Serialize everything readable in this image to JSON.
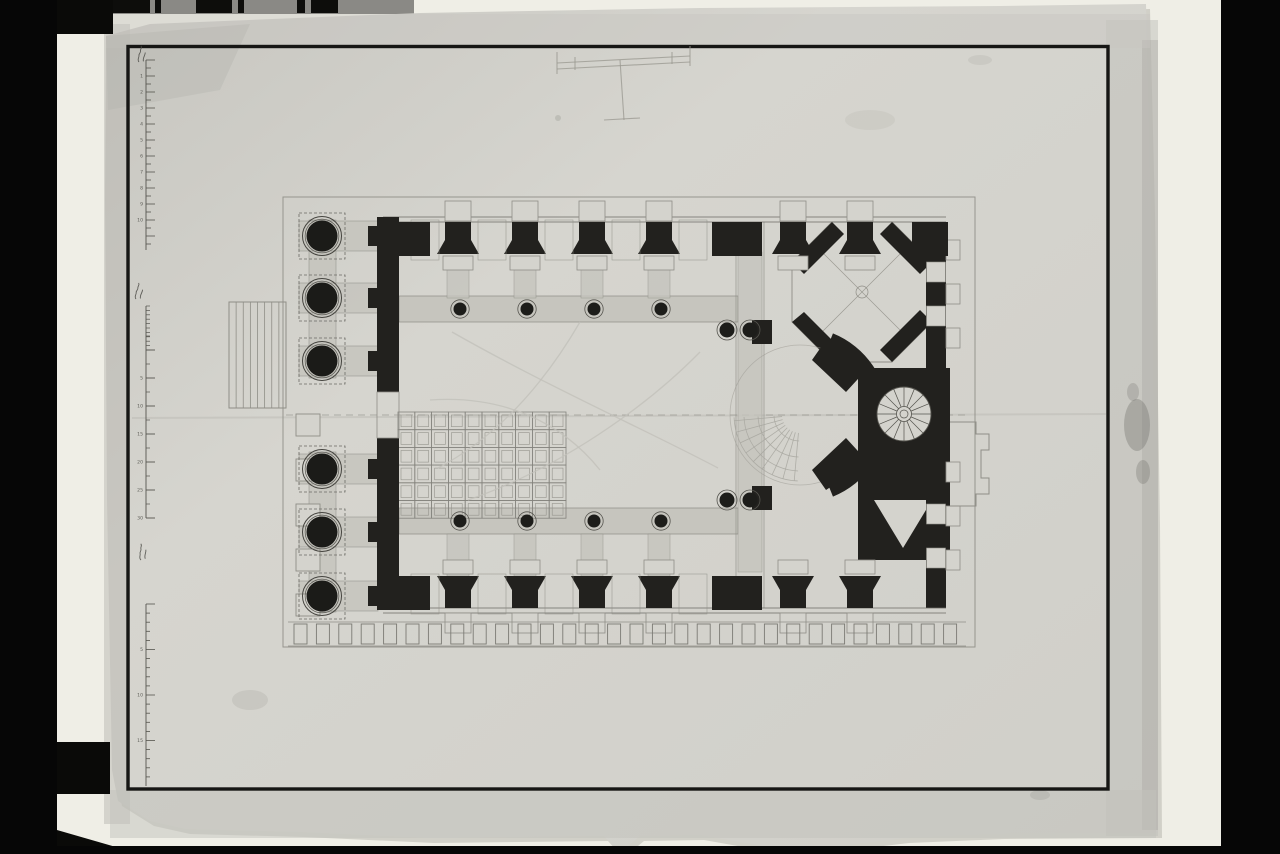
{
  "colors": {
    "photo_black": "#060606",
    "backdrop_white": "#efeee6",
    "paper": "#d4d3cd",
    "paper_edge": "#b9b8b2",
    "ink_border": "#161614",
    "ink": "#22211e",
    "wash": "#c6c5be",
    "wash_edge": "#8d8c85",
    "faint": "#8f8e87",
    "ghost": "#c2c1ba",
    "stain": "#6e6d66",
    "strip_grey": "#8a8985",
    "numeral": "#4a4a44"
  },
  "photo": {
    "left_bar": [
      0,
      0,
      57,
      854
    ],
    "right_bar": [
      1221,
      0,
      59,
      854
    ],
    "backdrop": [
      57,
      0,
      1164,
      848
    ],
    "top_left_block": [
      0,
      0,
      113,
      34
    ],
    "bottom_left_block": [
      56,
      742,
      54,
      52
    ],
    "bottom_strip": [
      0,
      846,
      1280,
      8
    ],
    "bottom_wedge": "57,830 57,854 140,854",
    "grey_strip": [
      106,
      0,
      308,
      14
    ],
    "grey_strip_blocks": [
      [
        112,
        38
      ],
      [
        155,
        6
      ],
      [
        196,
        36
      ],
      [
        238,
        6
      ],
      [
        297,
        8
      ],
      [
        311,
        27
      ]
    ]
  },
  "paper": {
    "outline": "106,36 150,24 420,13 700,8 1000,6 1146,4 1151,210 1156,520 1158,833 1000,834 905,838 830,847 762,846 700,835 640,836 628,846 612,845 604,836 430,838 300,832 186,829 150,821 118,801 112,770 107,500 105,200",
    "ink_border": [
      128,
      46.5,
      980,
      742.5
    ],
    "crease": [
      132,
      418,
      1106,
      414
    ],
    "stains": [
      [
        1137,
        425,
        13,
        26,
        0.35
      ],
      [
        1143,
        472,
        7,
        12,
        0.3
      ],
      [
        1133,
        392,
        6,
        9,
        0.25
      ],
      [
        558,
        118,
        3,
        3,
        0.2
      ],
      [
        250,
        700,
        18,
        10,
        0.12
      ],
      [
        1040,
        795,
        10,
        5,
        0.15
      ],
      [
        980,
        60,
        12,
        5,
        0.1
      ],
      [
        870,
        120,
        25,
        10,
        0.08
      ]
    ]
  },
  "sketch_t": {
    "paths": [
      "M557,63 L690,56",
      "M557,69 L690,62",
      "M557,52 L557,74",
      "M690,46 L690,66",
      "M620,60 L624,120",
      "M604,120 L640,118",
      "M575,57 L575,70",
      "M672,52 L672,64"
    ]
  },
  "rulers": {
    "a": {
      "x": 146,
      "y1": 60,
      "y2": 250,
      "pitch": 8,
      "len": 5,
      "long_len": 9,
      "long_every": 2,
      "numerals": [
        "1",
        "2",
        "3",
        "4",
        "5",
        "6",
        "7",
        "8",
        "9",
        "10"
      ],
      "label": [
        139,
        62,
        -72
      ]
    },
    "b": {
      "x": 146,
      "fine_y1": 306,
      "fine_y2": 350,
      "fine_pitch": 4.4,
      "major_y1": 350,
      "major_y2": 518,
      "major_pitch": 28,
      "len": 4,
      "long_len": 9,
      "numerals": [
        "5",
        "10",
        "15",
        "20",
        "25",
        "30"
      ],
      "label": [
        136,
        299,
        -70
      ]
    },
    "c": {
      "x": 146,
      "y1": 604,
      "y2": 786,
      "pitch": 9.1,
      "len": 4,
      "long_len": 9,
      "long_every": 5,
      "numerals": [
        "5",
        "10",
        "15",
        "20"
      ],
      "label": [
        141,
        560,
        -80
      ]
    }
  },
  "plan": {
    "outer": [
      283,
      197,
      692,
      450
    ],
    "axis": [
      286,
      415,
      970,
      415
    ],
    "portico": {
      "col_x": 322,
      "col_r": 15.5,
      "ring_r": 19.5,
      "plinth": 46,
      "rows": [
        236,
        298,
        361,
        469,
        532,
        596
      ],
      "hband": [
        299,
        378,
        30
      ],
      "vbands": [
        [
          309,
          220,
          27,
          158
        ],
        [
          309,
          452,
          27,
          160
        ]
      ]
    },
    "steps": {
      "x": 229,
      "y": 302,
      "w": 57,
      "h": 106,
      "risers": 7
    },
    "west_wall": {
      "x": 377,
      "w": 22,
      "segs": [
        [
          217,
          392
        ],
        [
          438,
          608
        ]
      ],
      "tab_rows": [
        236,
        298,
        361,
        469,
        532,
        596
      ]
    },
    "west_pilasters": {
      "x": 296,
      "w": 24,
      "h": 22,
      "cys": [
        425,
        470,
        515,
        560,
        605
      ]
    },
    "wall_piers": [
      458,
      525,
      592,
      659
    ],
    "east_piers": [
      793,
      860
    ],
    "gaps": [
      425,
      492,
      559,
      626,
      693
    ],
    "north": {
      "lines": [
        217,
        222
      ],
      "pier_y": [
        222,
        240,
        254
      ],
      "tab_y": 201,
      "base_y": 256,
      "wash": [
        258,
        40
      ],
      "corners": [
        [
          377,
          53
        ],
        [
          712,
          50
        ],
        [
          912,
          36
        ]
      ]
    },
    "south": {
      "lines": [
        608,
        613
      ],
      "pier_y": [
        608,
        590,
        576
      ],
      "tab_y": 613,
      "base_y": 560,
      "wash": [
        534,
        42
      ],
      "corners": [
        [
          377,
          53
        ],
        [
          712,
          50
        ]
      ]
    },
    "colonnade": {
      "band_x": [
        399,
        738
      ],
      "top_y": 296,
      "bot_y": 508,
      "band_h": 26,
      "cols_x": [
        460,
        527,
        594,
        661
      ],
      "top_cy": 309,
      "bot_cy": 521,
      "r": 6.5,
      "ring": 9.2
    },
    "paired_cols": [
      [
        727,
        330
      ],
      [
        750,
        330
      ],
      [
        727,
        500
      ],
      [
        750,
        500
      ]
    ],
    "crossing": {
      "wash": [
        738,
        252,
        24,
        320
      ],
      "lines_x": [
        736,
        764
      ],
      "line_y": [
        222,
        608
      ]
    },
    "coffers": {
      "x": 398,
      "y": 412,
      "cols": 10,
      "rows": 6,
      "cw": 16.8,
      "ch": 17.7,
      "inset": 3
    },
    "ghost_arcs": [
      "M438,468 C510,430 555,365 580,322",
      "M452,332 C545,385 650,432 718,468",
      "M468,500 C560,468 645,408 700,352",
      "M430,400 C500,395 560,420 600,470"
    ],
    "apse": {
      "cx": 800,
      "cy": 415,
      "r_out": 88,
      "r_in": 70,
      "half_angle": 68,
      "rib_r1": 18,
      "rib_r2": 66,
      "rib_angles": [
        95,
        105,
        115,
        125,
        135,
        145,
        155,
        165,
        175
      ],
      "arc_radii": [
        26,
        42,
        56,
        66
      ],
      "piers": [
        [
          752,
          320,
          20,
          24
        ],
        [
          752,
          486,
          20,
          24
        ]
      ]
    },
    "octagon": {
      "pts": "832,222 892,222 932,262 932,322 892,362 832,362 792,322 792,262",
      "corner_bands": [
        "832,222 792,262 804,274 844,234",
        "892,222 932,262 920,274 880,234",
        "792,322 832,362 844,352 804,312",
        "932,322 892,362 880,350 920,310"
      ],
      "diagonals": [
        [
          812,
          242,
          912,
          342
        ],
        [
          912,
          242,
          812,
          342
        ]
      ],
      "hub": 6
    },
    "stair": {
      "block": [
        858,
        368,
        92,
        94
      ],
      "cx": 904,
      "cy": 414,
      "r": 27,
      "hub": 7.5,
      "treads": 16,
      "connect": [
        "826,340 868,368 846,392 812,360",
        "812,470 846,438 868,462 826,490"
      ]
    },
    "se_block": {
      "rect": [
        858,
        462,
        92,
        98
      ],
      "notch": "874,500 932,500 903,548"
    },
    "east_wall": {
      "x": 926,
      "w": 20,
      "segs": [
        [
          222,
          368
        ],
        [
          462,
          608
        ]
      ],
      "gaps": [
        [
          262,
          282
        ],
        [
          306,
          326
        ],
        [
          504,
          524
        ],
        [
          548,
          568
        ]
      ],
      "tabs": [
        250,
        294,
        338,
        472,
        516,
        560
      ],
      "echelon": "M950,422 L976,422 L976,434 L989,434 L989,450 L981,450 L981,478 L989,478 L989,494 L976,494 L976,506 L950,506"
    },
    "dentils": {
      "y": 624,
      "h": 20,
      "w": 13,
      "start": 294,
      "pitch": 22.4,
      "count": 30,
      "lines": [
        622,
        646
      ]
    }
  }
}
